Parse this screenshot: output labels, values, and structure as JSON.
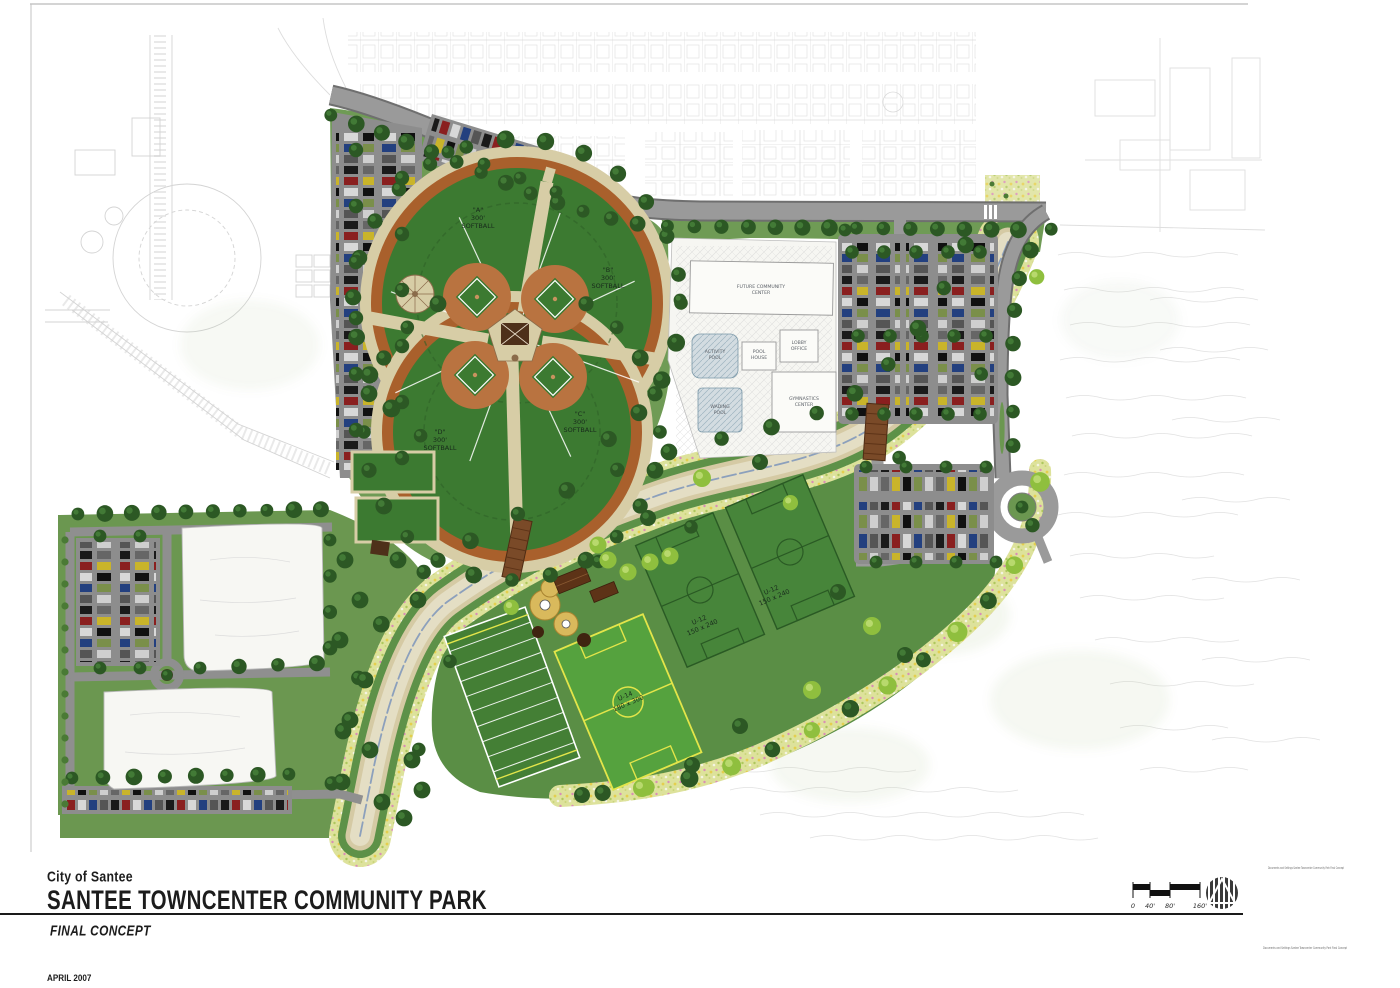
{
  "title_block": {
    "city": "City of Santee",
    "park_name": "SANTEE TOWNCENTER COMMUNITY PARK",
    "phase": "FINAL CONCEPT",
    "date": "APRIL 2007"
  },
  "scale_bar": {
    "t0": "0",
    "t40": "40'",
    "t80": "80'",
    "t160": "160'"
  },
  "file_notes": {
    "top": "Documents and Settings  Santee Towncenter Community Park  Final Concept",
    "bottom": "Documents and Settings  Santee Towncenter Community Park  Final Concept"
  },
  "fields": {
    "softball_a": {
      "name": "\"A\"",
      "distance": "300'",
      "sport": "SOFTBALL"
    },
    "softball_b": {
      "name": "\"B\"",
      "distance": "300'",
      "sport": "SOFTBALL"
    },
    "softball_c": {
      "name": "\"C\"",
      "distance": "300'",
      "sport": "SOFTBALL"
    },
    "softball_d": {
      "name": "\"D\"",
      "distance": "300'",
      "sport": "SOFTBALL"
    },
    "soccer_left": {
      "name": "U-12",
      "size": "150 x 240"
    },
    "soccer_right": {
      "name": "U-12",
      "size": "150 x 240"
    },
    "soccer_u14": {
      "name": "U-14",
      "size": "180 x 300"
    }
  },
  "buildings": {
    "community_center": {
      "l1": "FUTURE COMMUNITY",
      "l2": "CENTER"
    },
    "lobby_office": {
      "l1": "LOBBY",
      "l2": "OFFICE"
    },
    "pool_house": {
      "l1": "POOL",
      "l2": "HOUSE"
    },
    "gymnastics": {
      "l1": "GYMNASTICS",
      "l2": "CENTER"
    },
    "activity_pool": {
      "l1": "ACTIVITY",
      "l2": "POOL"
    },
    "wading_pool": {
      "l1": "WADING",
      "l2": "POOL"
    }
  },
  "colors": {
    "field_green": "#3c7a31",
    "meadow_green": "#5a8e45",
    "lawn_green": "#6f9b55",
    "infield_clay": "#b97340",
    "promenade_orange": "#a9602c",
    "creek_bed": "#e4dec4",
    "creek_water": "#7d95bb",
    "wildflower": "#dde29b",
    "asphalt": "#8d8d8d",
    "tree_dark": "#2c5824",
    "tree_accent": "#8fbf3e"
  }
}
